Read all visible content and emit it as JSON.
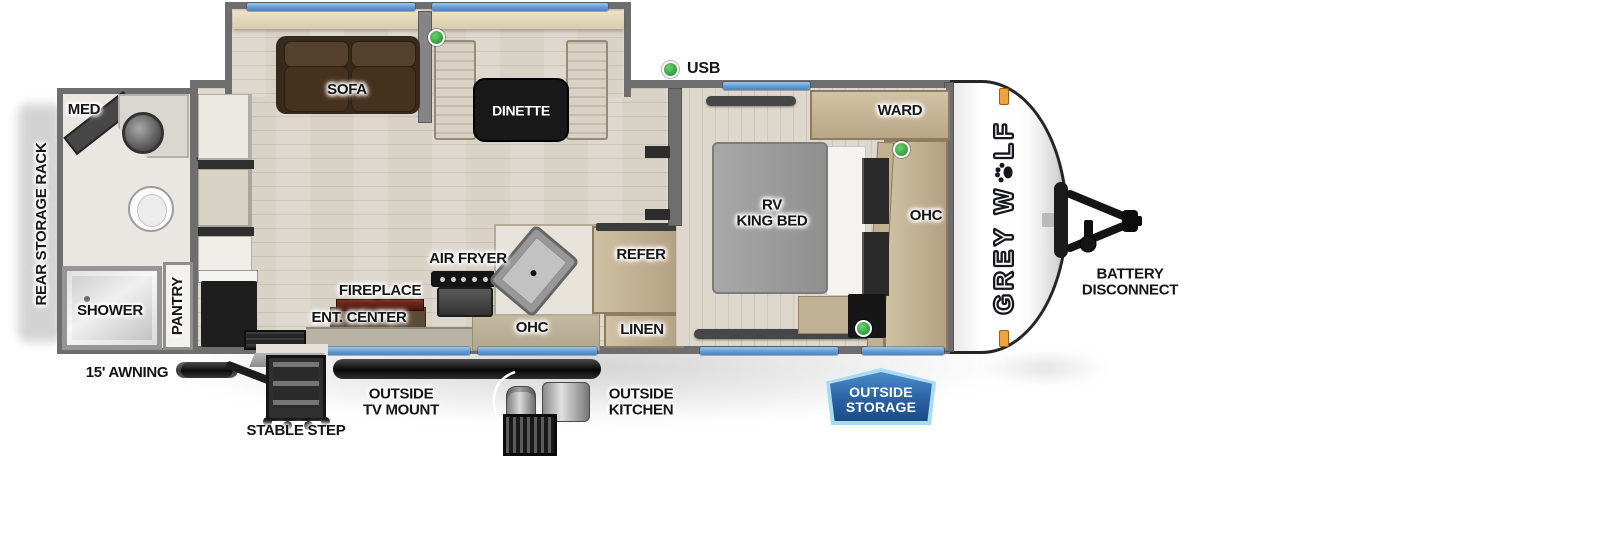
{
  "floorplan": {
    "brand": {
      "logo_prefix": "GREY W",
      "logo_suffix": "LF",
      "paw_icon": "wolf-paw-print"
    },
    "legend": {
      "usb_label": "USB"
    },
    "rooms": {
      "bathroom": {
        "med": "MED",
        "shower": "SHOWER",
        "pantry": "PANTRY"
      },
      "living": {
        "sofa": "SOFA",
        "dinette": "DINETTE",
        "fireplace": "FIREPLACE",
        "ent_center": "ENT. CENTER",
        "air_fryer": "AIR FRYER",
        "ohc": "OHC"
      },
      "kitchen": {
        "refer": "REFER",
        "linen": "LINEN"
      },
      "bedroom": {
        "ward": "WARD",
        "bed": "RV\nKING BED",
        "ohc": "OHC"
      }
    },
    "exterior": {
      "rear_storage_rack": "REAR STORAGE RACK",
      "awning": "15' AWNING",
      "stable_step": "STABLE STEP",
      "outside_tv_mount": "OUTSIDE\nTV MOUNT",
      "outside_kitchen": "OUTSIDE\nKITCHEN",
      "outside_storage": "OUTSIDE\nSTORAGE",
      "battery_disconnect": "BATTERY\nDISCONNECT"
    },
    "colors": {
      "window_blue": "#5e98d2",
      "usb_green": "#3bb34a",
      "badge_blue": "#2a62a4",
      "badge_border": "#a9dcef",
      "wall_gray": "#6e6e6e",
      "marker_orange": "#f0a43c"
    }
  }
}
